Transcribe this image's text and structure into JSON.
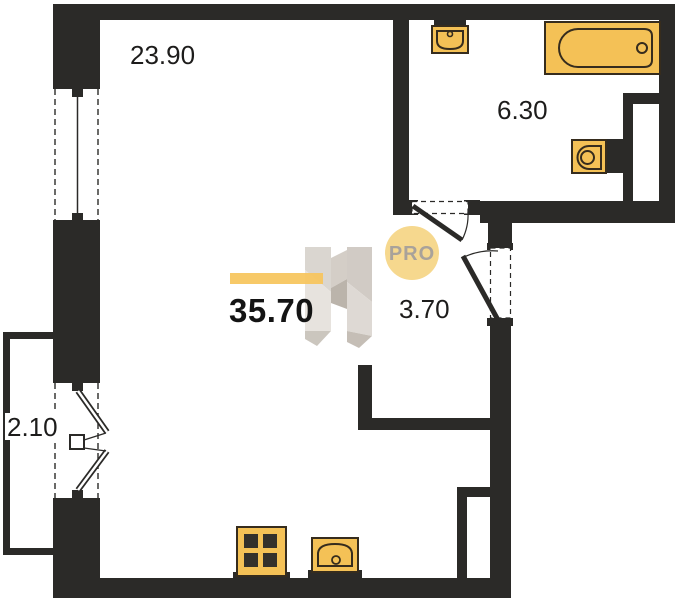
{
  "floor_plan": {
    "areas": {
      "total": "35.70",
      "living_room": "23.90",
      "bathroom": "6.30",
      "hallway": "3.70",
      "balcony": "2.10"
    },
    "watermark": {
      "badge": "PRO"
    },
    "fixtures": [
      "bathtub",
      "bathroom-sink",
      "toilet",
      "stove",
      "kitchen-sink"
    ],
    "colors": {
      "wall": "#2b2a28",
      "fixture_fill": "#f4c156",
      "fixture_outline": "#362c1d",
      "burner": "#33302b",
      "accent_bar": "#f6c55c",
      "badge_fill": "#f6d88e",
      "badge_text": "#a9a29a",
      "watermark_gray": "#d2ccc5",
      "label_text": "#1d1c1b"
    }
  }
}
